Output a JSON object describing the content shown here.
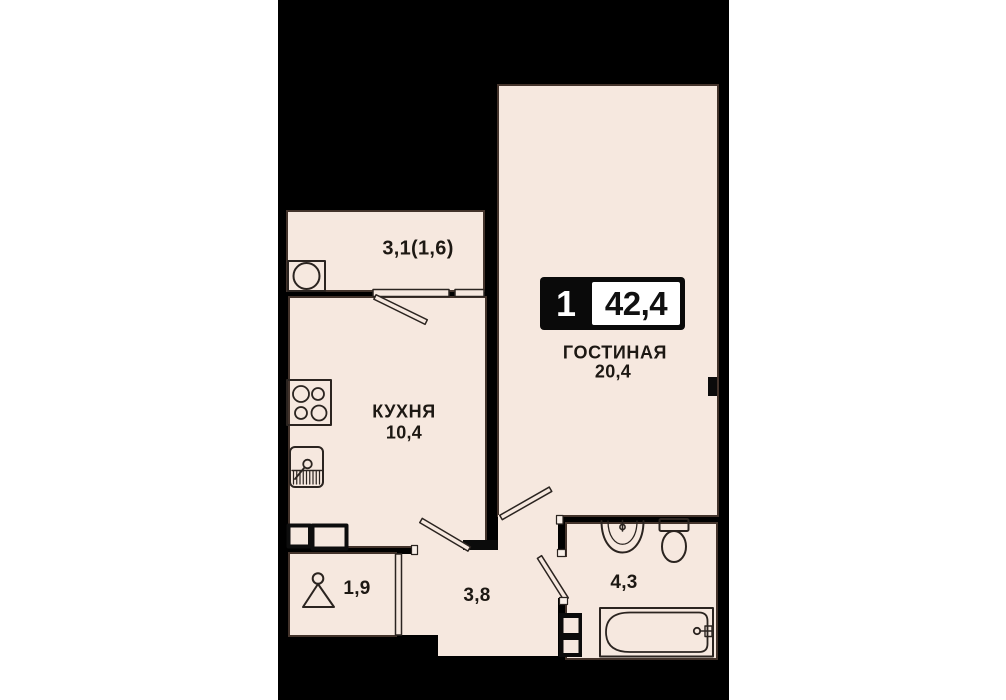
{
  "plan": {
    "canvas": {
      "page_background": "#ffffff",
      "band_fill": "#000000",
      "room_fill": "#f6e8df",
      "line_color": "#2b2420"
    },
    "badge": {
      "rooms_count": "1",
      "total_area": "42,4"
    },
    "labels": {
      "balcony_area": "3,1(1,6)",
      "living_name": "ГОСТИНАЯ",
      "living_area": "20,4",
      "kitchen_name": "КУХНЯ",
      "kitchen_area": "10,4",
      "closet_area": "1,9",
      "hall_area": "3,8",
      "bath_area": "4,3"
    },
    "fixtures": [
      "boiler",
      "balcony-window",
      "balcony-door",
      "stove",
      "kitchen-sink",
      "wall-cabinets",
      "hanger",
      "sliding-door",
      "kitchen-door",
      "living-door",
      "bath-door",
      "washer-shaft",
      "bath-sink",
      "toilet",
      "bathtub",
      "bath-faucet"
    ]
  }
}
